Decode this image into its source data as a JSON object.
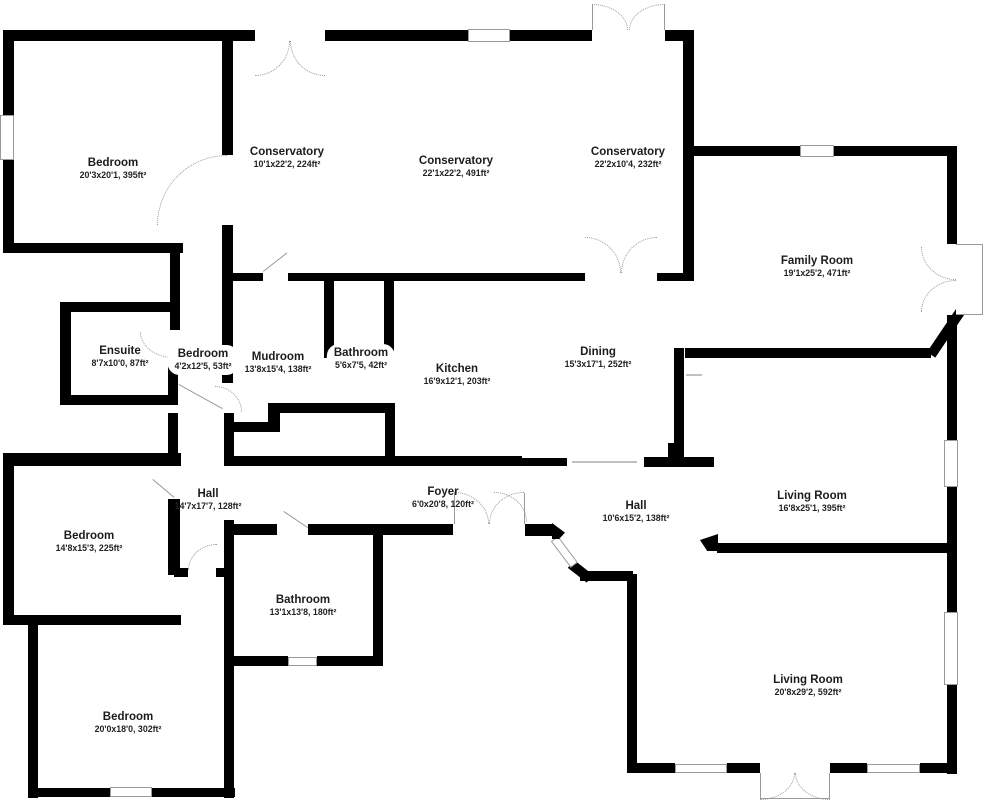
{
  "page": {
    "background": "#ffffff",
    "wall_color": "#000000",
    "detail_color": "#999999"
  },
  "floor_plan": {
    "rooms": [
      {
        "name": "Bedroom",
        "dims": "20'3x20'1, 395ft²",
        "x": 113,
        "y": 164,
        "pill": false
      },
      {
        "name": "Conservatory",
        "dims": "10'1x22'2, 224ft²",
        "x": 287,
        "y": 153,
        "pill": false
      },
      {
        "name": "Conservatory",
        "dims": "22'1x22'2, 491ft²",
        "x": 456,
        "y": 162,
        "pill": false
      },
      {
        "name": "Conservatory",
        "dims": "22'2x10'4, 232ft²",
        "x": 628,
        "y": 153,
        "pill": false
      },
      {
        "name": "Family Room",
        "dims": "19'1x25'2, 471ft²",
        "x": 817,
        "y": 262,
        "pill": false
      },
      {
        "name": "Ensuite",
        "dims": "8'7x10'0, 87ft²",
        "x": 120,
        "y": 352,
        "pill": false
      },
      {
        "name": "Bedroom",
        "dims": "4'2x12'5, 53ft²",
        "x": 203,
        "y": 355,
        "pill": true
      },
      {
        "name": "Mudroom",
        "dims": "13'8x15'4, 138ft²",
        "x": 278,
        "y": 358,
        "pill": false
      },
      {
        "name": "Bathroom",
        "dims": "5'6x7'5, 42ft²",
        "x": 361,
        "y": 354,
        "pill": true
      },
      {
        "name": "Kitchen",
        "dims": "16'9x12'1, 203ft²",
        "x": 457,
        "y": 370,
        "pill": false
      },
      {
        "name": "Dining",
        "dims": "15'3x17'1, 252ft²",
        "x": 598,
        "y": 353,
        "pill": false
      },
      {
        "name": "Hall",
        "dims": "14'7x17'7, 128ft²",
        "x": 208,
        "y": 495,
        "pill": false
      },
      {
        "name": "Foyer",
        "dims": "6'0x20'8, 120ft²",
        "x": 443,
        "y": 493,
        "pill": false
      },
      {
        "name": "Hall",
        "dims": "10'6x15'2, 138ft²",
        "x": 636,
        "y": 507,
        "pill": false
      },
      {
        "name": "Living Room",
        "dims": "16'8x25'1, 395ft²",
        "x": 812,
        "y": 497,
        "pill": false
      },
      {
        "name": "Bedroom",
        "dims": "14'8x15'3, 225ft²",
        "x": 89,
        "y": 537,
        "pill": false
      },
      {
        "name": "Bathroom",
        "dims": "13'1x13'8, 180ft²",
        "x": 303,
        "y": 601,
        "pill": false
      },
      {
        "name": "Bedroom",
        "dims": "20'0x18'0, 302ft²",
        "x": 128,
        "y": 718,
        "pill": false
      },
      {
        "name": "Living Room",
        "dims": "20'8x29'2, 592ft²",
        "x": 808,
        "y": 681,
        "pill": false
      }
    ]
  }
}
